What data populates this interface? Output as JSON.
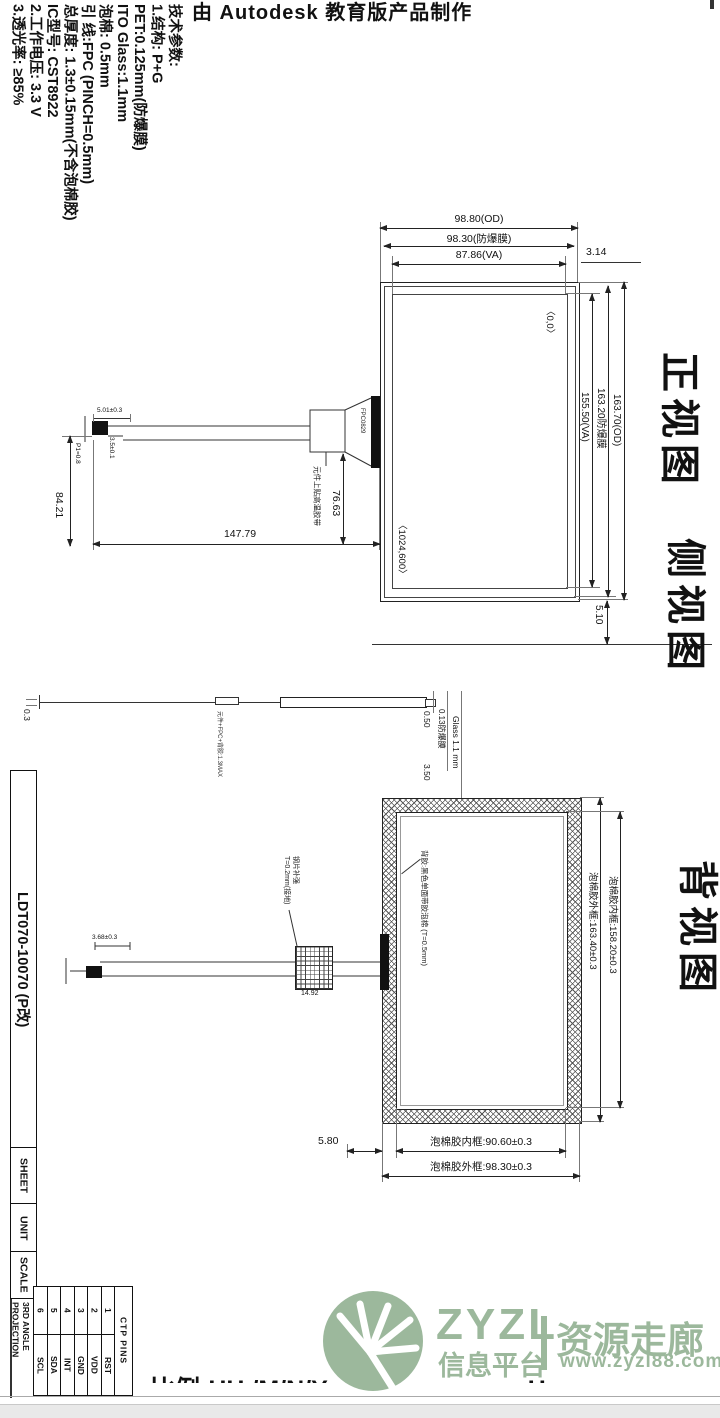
{
  "banner": {
    "text": "由 Autodesk 教育版产品制作"
  },
  "tech_specs": {
    "title": "技术参数:",
    "lines": [
      "1.结构: P+G",
      "PET:0.125mm(防爆膜)",
      "ITO Glass:1.1mm",
      "泡棉: 0.5mm",
      "引 线:FPC (PINCH=0.5mm)",
      "总厚度: 1.3±0.15mm(不含泡棉胶)",
      "IC型号: CST8922",
      "2.工作电压: 3.3 V",
      "3.透光率: ≥85%"
    ]
  },
  "view_labels": {
    "front": "正视图",
    "side": "侧视图",
    "back": "背视图"
  },
  "front_view": {
    "dim_od_w": "98.80(OD)",
    "dim_film_w": "98.30(防爆膜)",
    "dim_va_w": "87.86(VA)",
    "dim_right_margin": "3.14",
    "dim_od_h": "163.70(OD)",
    "dim_film_h": "163.20防爆膜",
    "dim_va_h": "155.50(VA)",
    "dim_bottom_margin": "5.10",
    "origin_label": "〈0,0〉",
    "resolution_label": "〈1024,600〉",
    "dim_tail_length": "147.79",
    "dim_tail_drop": "84.21",
    "dim_tail_offset": "76.63",
    "dim_tail_width": "5.01±0.3",
    "dim_tail_pitch": "3.5±0.1",
    "dim_p1": "P1=0.8",
    "connector_label": "FPC0829",
    "tape_note": "元件上贴高温胶带"
  },
  "side_view": {
    "dim_left": "0.3",
    "dim_pet": "0.50",
    "dim_film": "0.13防爆膜",
    "dim_glass": "Glass 1.1 mm",
    "dim_foam": "3.50",
    "stack_note": "元件+FPC+背胶:1.3MAX"
  },
  "back_view": {
    "adhesive_note": "背胶:黑色单面带胶泡棉 (T=0.5mm)",
    "dim_foam_outer_h": "泡棉胶外框:163.40±0.3",
    "dim_foam_inner_h": "泡棉胶内框:158.20±0.3",
    "dim_foam_inner_w": "泡棉胶内框:90.60±0.3",
    "dim_foam_outer_w": "泡棉胶外框:98.30±0.3",
    "dim_offset": "5.80",
    "stiffener_note_1": "钢片补强",
    "stiffener_note_2": "T=0.2mm(接地)",
    "dim_stiffener_w": "14.92",
    "dim_tail": "3.68±0.3"
  },
  "title_block": {
    "part_number": "LDT070-10070 (P改)",
    "sheet": "SHEET",
    "unit": "UNIT",
    "scale": "SCALE",
    "projection_1": "3RD ANGLE",
    "projection_2": "PROJECTION"
  },
  "ctp_pins": {
    "header": "CTP PINS",
    "pins": [
      {
        "num": "1",
        "name": "RST"
      },
      {
        "num": "2",
        "name": "VDD"
      },
      {
        "num": "3",
        "name": "GND"
      },
      {
        "num": "4",
        "name": "INT"
      },
      {
        "num": "5",
        "name": "SDA"
      },
      {
        "num": "6",
        "name": "SCL"
      }
    ]
  },
  "watermark": {
    "brand": "ZYZL",
    "tagline": "信息平台",
    "name_cn": "资源走廊",
    "url": "www.zyzl88.com",
    "color": "#9CB89C"
  },
  "footer": {
    "clipped_text": "比例:HH /M/N/Y————————H"
  }
}
